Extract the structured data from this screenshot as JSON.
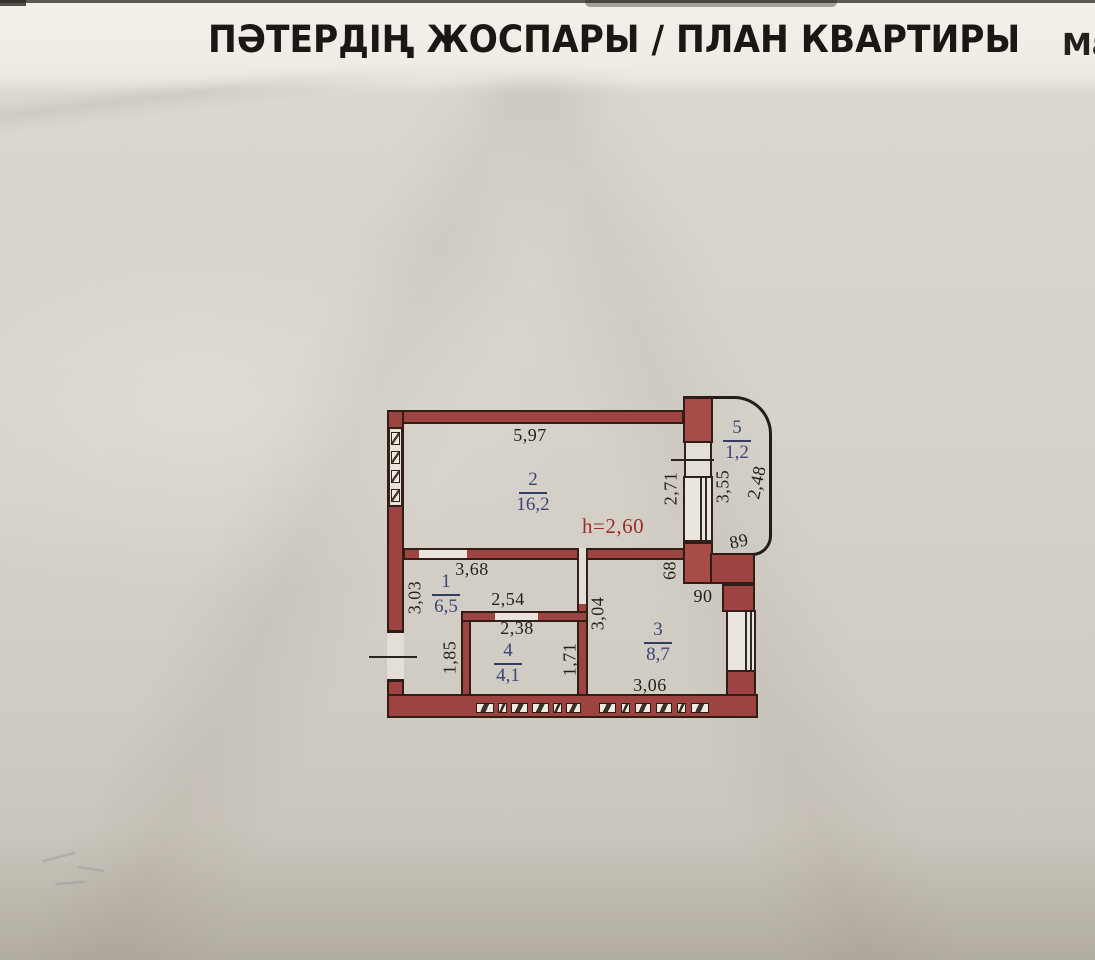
{
  "header": {
    "title": "ПӘТЕРДІҢ ЖОСПАРЫ / ПЛАН КВАРТИРЫ",
    "right_edge_text": "Ма"
  },
  "plan": {
    "height_label": "h=2,60",
    "rooms": [
      {
        "number": "2",
        "area": "16,2"
      },
      {
        "number": "1",
        "area": "6,5"
      },
      {
        "number": "4",
        "area": "4,1"
      },
      {
        "number": "3",
        "area": "8,7"
      },
      {
        "number": "5",
        "area": "1,2"
      }
    ],
    "dims": {
      "room2_width": "5,97",
      "wall2_right": "2,71",
      "balcony_inner": "3,55",
      "balcony_arc": "2,48",
      "balcony_width": "89",
      "corridor_width": "3,68",
      "corridor_left": "3,03",
      "corridor_inner": "2,54",
      "corridor_left_lower": "1,85",
      "bath_width": "2,38",
      "bath_right": "1,71",
      "kitchen_left": "3,04",
      "kitchen_top": "68",
      "kitchen_step": "90",
      "kitchen_width": "3,06"
    }
  },
  "colors": {
    "wall_fill": "#9d4342",
    "wall_outline": "#301e15",
    "room_label_blue": "#3a4576",
    "dimension_text": "#262019",
    "height_note_red": "#9c2e28",
    "paper": "#d5d1c9",
    "paper_top": "#f3f0ea",
    "balcony_line": "#211d18"
  }
}
